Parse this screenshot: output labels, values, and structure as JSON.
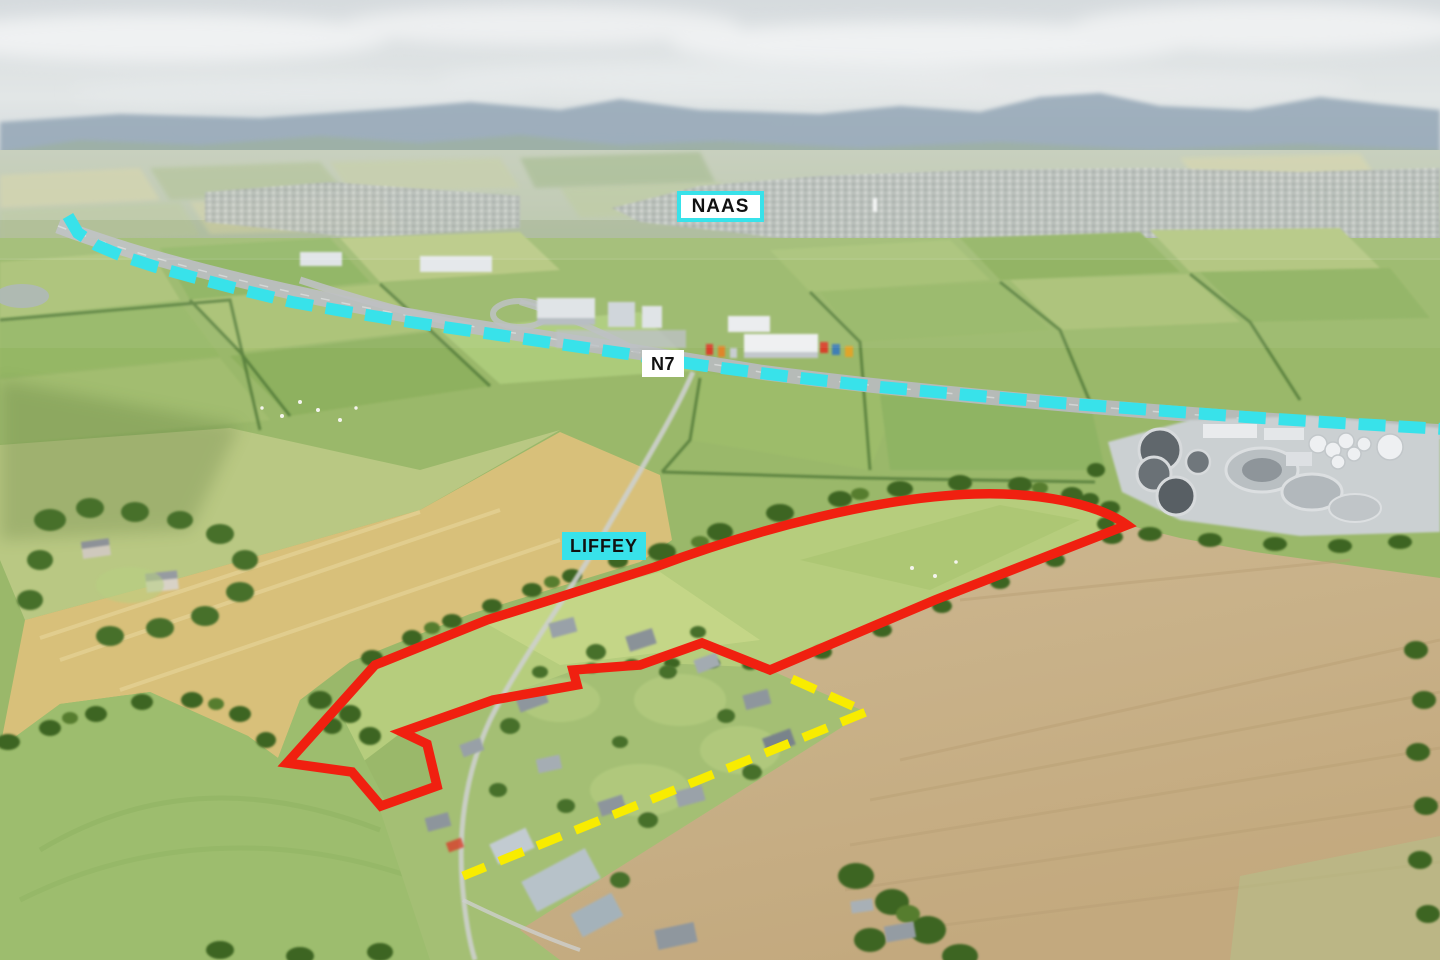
{
  "page": {
    "type": "annotated aerial photograph",
    "width_px": 1440,
    "height_px": 960
  },
  "labels": {
    "naas": {
      "text": "NAAS",
      "background": "#ffffff",
      "border_color": "#38e2ea",
      "text_color": "#111111"
    },
    "n7": {
      "text": "N7",
      "background": "#ffffff",
      "text_color": "#111111"
    },
    "liffey": {
      "text": "LIFFEY",
      "background": "#38e2ea",
      "text_color": "#111111"
    }
  },
  "annotations": {
    "n7_route": {
      "style": "dashed",
      "color": "#38e2ea"
    },
    "site_boundary": {
      "style": "solid",
      "color": "#f02010"
    },
    "secondary_boundary": {
      "style": "dashed",
      "color": "#f8ec00"
    }
  }
}
